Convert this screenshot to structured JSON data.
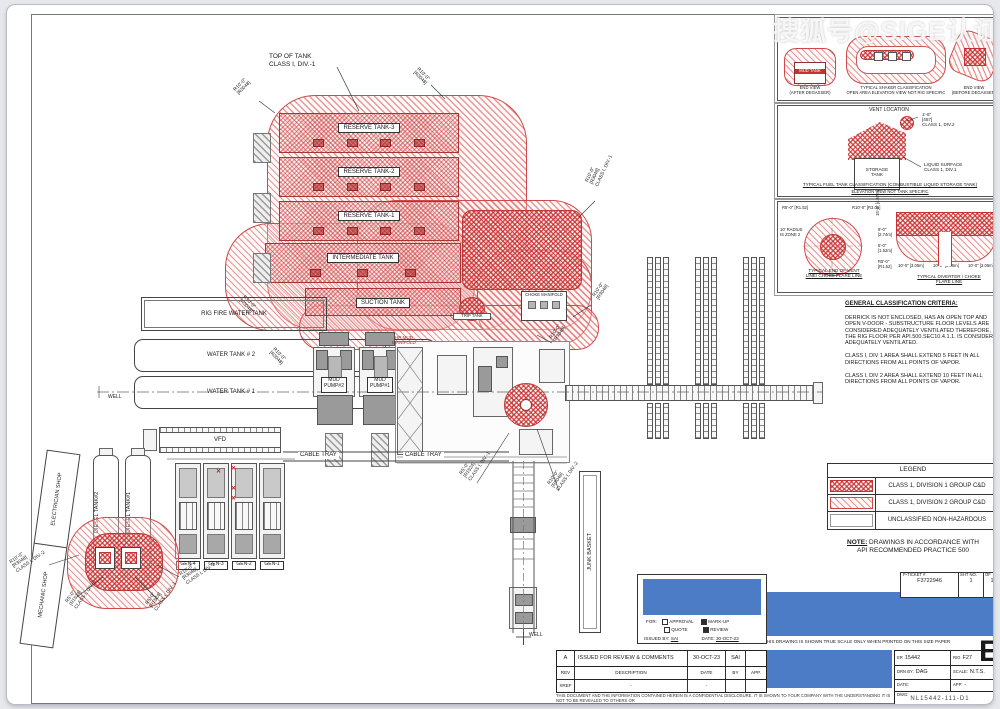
{
  "watermark": "搜狐号@SIGE认证 /M",
  "annotations": {
    "top_of_tank_1": "TOP OF TANK",
    "top_of_tank_2": "CLASS I, DIV.-1",
    "r10_ft": "R10'-0\"",
    "r10_mm": "[R3048]",
    "r5_ft": "R5'-0\"",
    "r5_mm": "[R1524]",
    "div1": "CLASS I, DIV.-1",
    "div2": "CLASS I, DIV.-2",
    "well": "WELL"
  },
  "tank_farm": {
    "tanks": [
      "RESERVE TANK-3",
      "RESERVE TANK-2",
      "RESERVE TANK-1",
      "INTERMEDIATE TANK",
      "SUCTION TANK"
    ],
    "trip_tank": "TRIP TANK",
    "choke_manifold": "CHOKE MANIFOLD",
    "hp_manifold_1": "HP MUD",
    "hp_manifold_2": "MANIFOLD"
  },
  "left_area": {
    "fire_tank": "RIG FIRE WATER TANK",
    "water_tank_2": "WATER TANK # 2",
    "water_tank_1": "WATER TANK # 1",
    "electrician_shop": "ELECTRICIAN SHOP",
    "mechanic_shop": "MECHANIC SHOP",
    "diesel_tank_2": "DIESEL TANK#2",
    "diesel_tank_1": "DIESEL TANK#1"
  },
  "equipment": {
    "mud_pump_2a": "MUD",
    "mud_pump_2b": "PUMP#2",
    "mud_pump_1a": "MUD",
    "mud_pump_1b": "PUMP#1",
    "vfd": "VFD",
    "cable_tray": "CABLE TRAY",
    "gens": [
      "GEN-4",
      "GEN-3",
      "GEN-2",
      "GEN-1"
    ],
    "junk_basket": "JUNK BASKET",
    "flare_mark": "✕"
  },
  "detail_shaker": {
    "left_cap_1": "END VIEW",
    "left_cap_2": "(AFTER DEGASSER)",
    "mud_tank": "MUD TANK",
    "mid_cap_1": "TYPICAL SHAKER CLASSIFICATION",
    "mid_cap_2": "OPEN AREA ELEVATION VIEW NOT RIG SPECIFIC",
    "right_cap_1": "END VIEW",
    "right_cap_2": "(BEFORE DEGASSER)"
  },
  "detail_fuel": {
    "vent": "VENT LOCATION",
    "vent_dim_1": "1'-6\"",
    "vent_dim_2": "[457]",
    "vent_dim_3": "CLASS 1, DIV.2",
    "storage_1": "STORAGE",
    "storage_2": "TANK",
    "liquid_1": "LIQUID SURFACE",
    "liquid_2": "CLASS 1, DIV.1",
    "title": "TYPICAL FUEL TANK CLASSIFICATION (COMBUSTIBLE LIQUID STORAGE TANK)",
    "subtitle": "ELEVATION VIEW NOT TANK SPECIFIC"
  },
  "detail_vent_end": {
    "r5": "R5'-0\" [R1.52]",
    "r10": "R10'-0\" [R3.05]",
    "zone_1": "10' RADIUS",
    "zone_2": "IS ZONE 2",
    "title_1": "TYPICAL END OF VENT",
    "title_2": "LINE/ CHOKE FLARE LINE"
  },
  "detail_diverter": {
    "dim_15": "15'-0\" [4.57m]",
    "dim_9a": "9'-0\"",
    "dim_9b": "[2.74m]",
    "dim_5a": "5'-0\"",
    "dim_5b": "[1.52m]",
    "dim_r5a": "R5'-0\"",
    "dim_r5b": "[R1.52]",
    "dim_10": "10'-0\" [3.05m]",
    "title_1": "TYPICAL DIVERTER / CHOKE",
    "title_2": "FLARE LINE"
  },
  "criteria": {
    "heading": "GENERAL CLASSIFICATION CRITERIA:",
    "p1": "DERRICK IS NOT ENCLOSED, HAS AN OPEN TOP AND OPEN V-DOOR - SUBSTRUCTURE FLOOR LEVELS ARE CONSIDERED ADEQUATELY VENTILATED THEREFORE, THE RIG FLOOR PER  API.500.SEC10.4.1.1. IS CONSIDERED ADEQUATELY VENTILATED.",
    "p2": "CLASS I, DIV 1 AREA SHALL EXTEND 5 FEET IN ALL DIRECTIONS FROM ALL POINTS OF VAPOR.",
    "p3": "CLASS I, DIV 2 AREA SHALL EXTEND 10 FEET IN ALL DIRECTIONS FROM ALL POINTS OF VAPOR."
  },
  "legend": {
    "title": "LEGEND",
    "rows": [
      {
        "label": "CLASS 1, DIVISION 1 GROUP C&D"
      },
      {
        "label": "CLASS 1, DIVISION 2 GROUP C&D"
      },
      {
        "label": "UNCLASSIFIED NON-HAZARDOUS"
      }
    ],
    "note_label": "NOTE:",
    "note_text": " DRAWINGS IN ACCORDANCE WITH",
    "note_line2": "API RECOMMENDED PRACTICE 500"
  },
  "title_block": {
    "approval": {
      "for_label": "FOR:",
      "opt_approval": "APPROVAL",
      "opt_quote": "QUOTE",
      "opt_markup": "MARK-UP",
      "opt_review": "REVIEW",
      "issued_by_label": "ISSUED BY:",
      "issued_by": "SAI",
      "date_label": "DATE:",
      "date": "30-OCT-23"
    },
    "pticket": {
      "label": "P-TICKET #",
      "value": "F3722946",
      "sht_label": "SHT NO.",
      "sht": "1",
      "of_label": "OF",
      "of": "1"
    },
    "scale_note": "THIS DRAWING IS SHOWN TRUE SCALE ONLY WHEN PRINTED ON THIS SIZE PAPER",
    "rev": {
      "r1c1": "A",
      "r1c2": "ISSUED FOR REVIEW & COMMENTS",
      "r1c3": "30-OCT-23",
      "r1c4": "SAI",
      "r1c5": "",
      "r2c1": "REV",
      "r2c2": "DESCRIPTION",
      "r2c3": "DATE",
      "r2c4": "BY",
      "r2c5": "APP.",
      "r3c1": "XREF",
      "r3c2": "-",
      "r3c3": "-"
    },
    "confidential": "THIS DOCUMENT AND THE INFORMATION CONTAINED HEREIN IS A CONFIDENTIAL DISCLOSURE. IT IS SHOWN TO YOUR COMPANY WITH THE UNDERSTANDING IT IS NOT TO BE REVEALED TO OTHERS OR",
    "info": {
      "er_label": "ER",
      "er": "15442",
      "rig_label": "RIG",
      "rig": "F27",
      "drn_label": "DRN BY:",
      "drn": "DAG",
      "scale_label": "SCALE:",
      "scale": "N.T.S.",
      "date_label": "DATE:",
      "app_label": "APP:",
      "app": "-",
      "dwg_label": "DWG:",
      "dwg": "NL15442-111-D1"
    },
    "size_letter": "E"
  }
}
